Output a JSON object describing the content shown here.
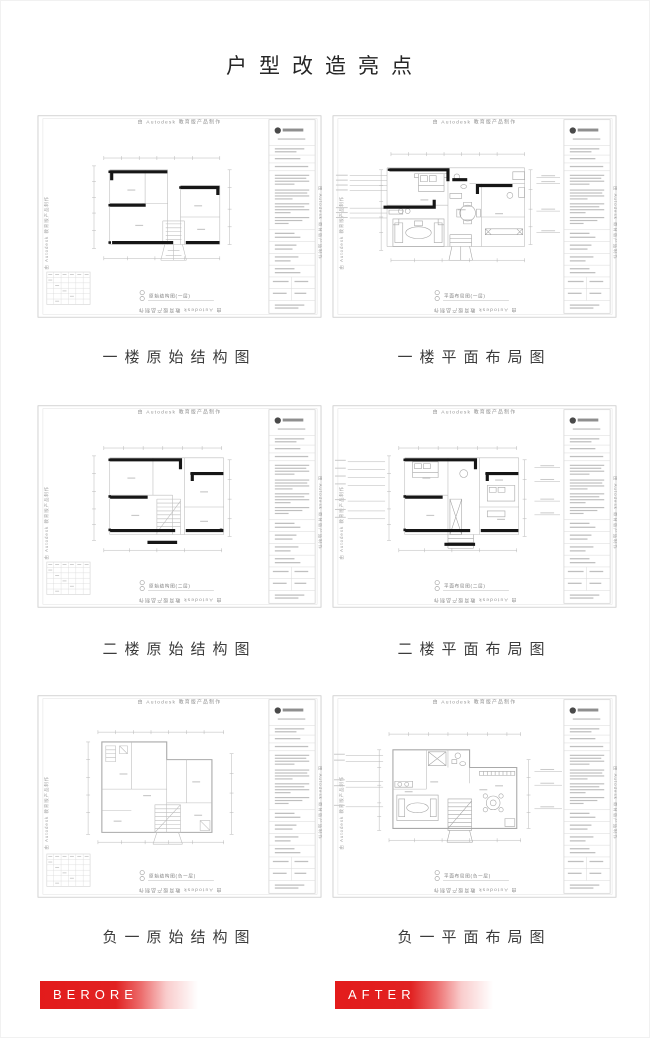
{
  "title": "户型改造亮点",
  "sheet": {
    "watermark": "由 Autodesk 教育版产品制作"
  },
  "plans": [
    {
      "caption": "一楼原始结构图",
      "sheet_label": "原始结构图(一层)"
    },
    {
      "caption": "一楼平面布局图",
      "sheet_label": "平面布局图(一层)"
    },
    {
      "caption": "二楼原始结构图",
      "sheet_label": "原始结构图(二层)"
    },
    {
      "caption": "二楼平面布局图",
      "sheet_label": "平面布局图(二层)"
    },
    {
      "caption": "负一原始结构图",
      "sheet_label": "原始结构图(负一层)"
    },
    {
      "caption": "负一平面布局图",
      "sheet_label": "平面布局图(负一层)"
    }
  ],
  "ribbons": {
    "before": "BERORE",
    "after": "AFTER"
  },
  "colors": {
    "accent_red": "#e31b1b",
    "wall": "#161616",
    "line": "#b6b6b6",
    "watermark": "#929292"
  }
}
